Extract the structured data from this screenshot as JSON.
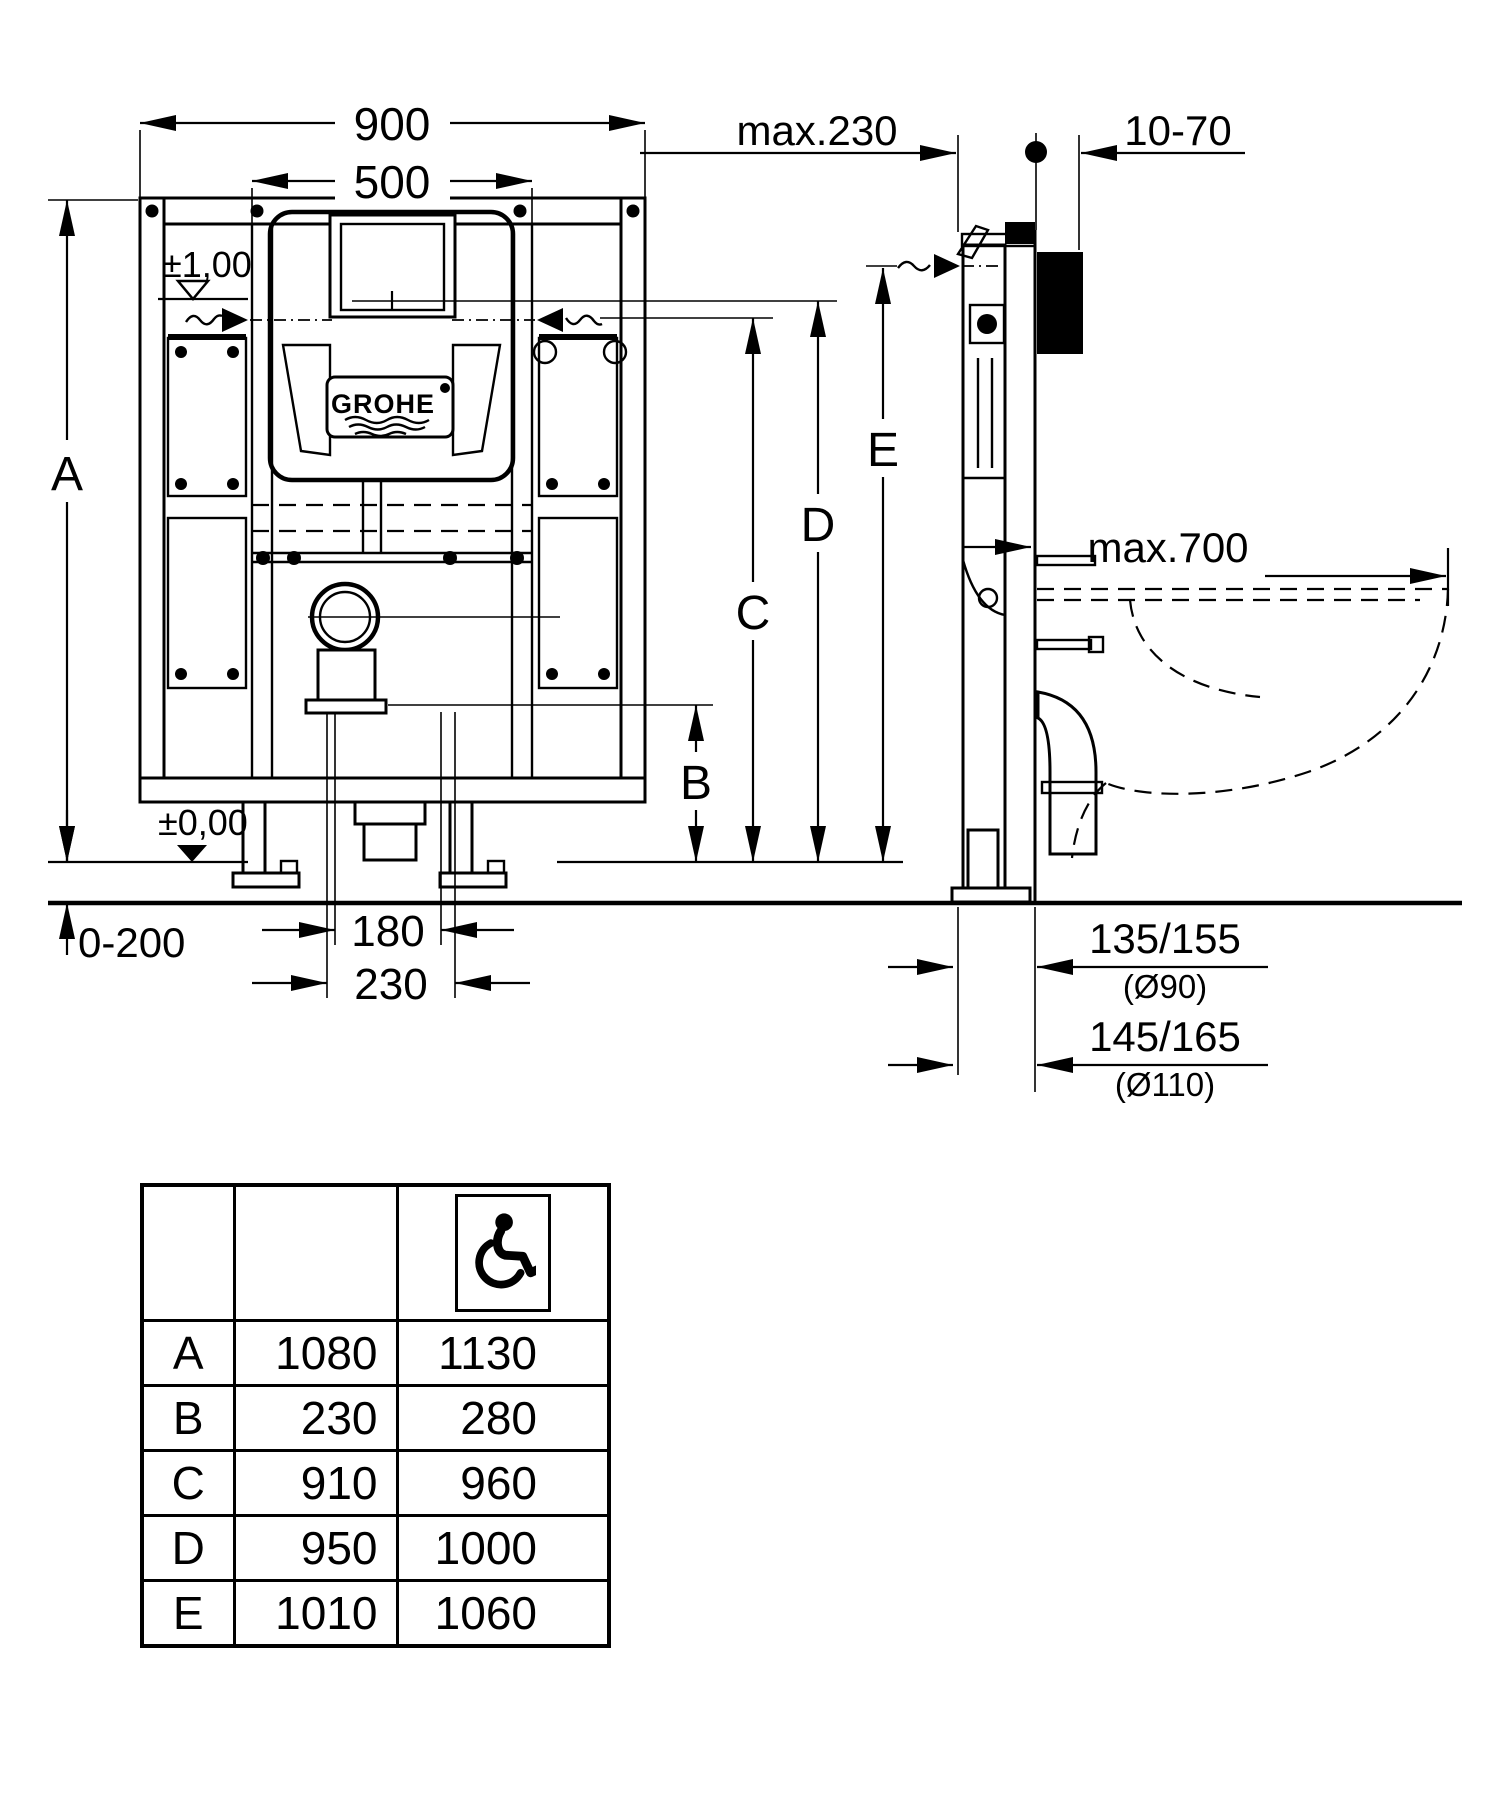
{
  "front": {
    "width_overall": "900",
    "width_inner": "500",
    "height_label": "A",
    "level_top": "±1,00",
    "level_zero": "±0,00",
    "floor_adjust": "0-200",
    "drain_dim_inner": "180",
    "drain_dim_outer": "230",
    "logo_text": "GROHE"
  },
  "heights": {
    "b": "B",
    "c": "C",
    "d": "D",
    "e": "E"
  },
  "side": {
    "wall_distance": "max.230",
    "covering_thickness": "10-70",
    "bowl_depth": "max.700",
    "drain_offset_90": "135/155",
    "drain_dia_90": "(Ø90)",
    "drain_offset_110": "145/165",
    "drain_dia_110": "(Ø110)"
  },
  "table": {
    "accessible_icon": "wheelchair-icon",
    "rows": [
      {
        "letter": "A",
        "standard": "1080",
        "accessible": "1130"
      },
      {
        "letter": "B",
        "standard": "230",
        "accessible": "280"
      },
      {
        "letter": "C",
        "standard": "910",
        "accessible": "960"
      },
      {
        "letter": "D",
        "standard": "950",
        "accessible": "1000"
      },
      {
        "letter": "E",
        "standard": "1010",
        "accessible": "1060"
      }
    ]
  }
}
